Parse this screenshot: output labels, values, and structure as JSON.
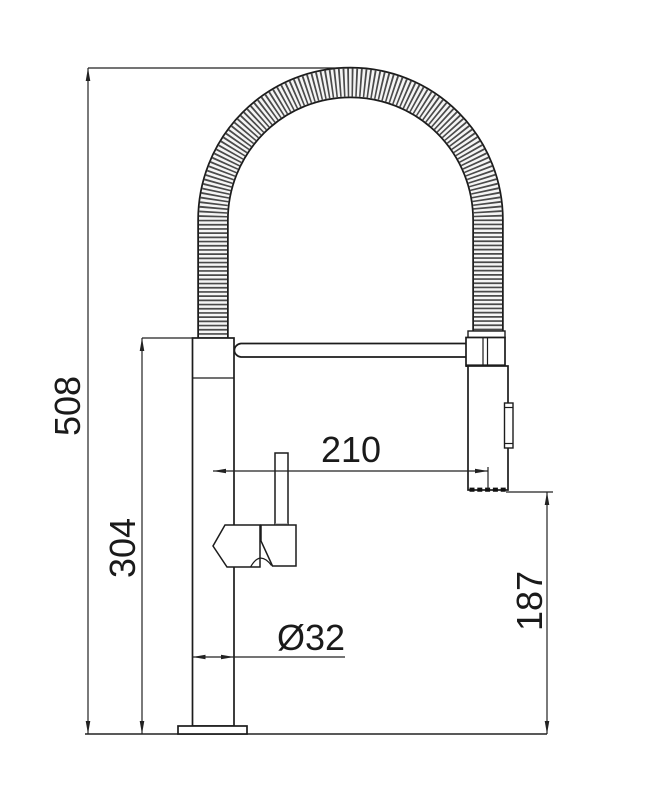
{
  "page": {
    "background_color": "#ffffff",
    "line_color": "#1c1c1c",
    "hose_rib_color": "#4a4a4a"
  },
  "dimensions": {
    "total_height": "508",
    "body_height": "304",
    "spout_reach": "210",
    "base_diameter": "Ø32",
    "head_clearance": "187"
  }
}
